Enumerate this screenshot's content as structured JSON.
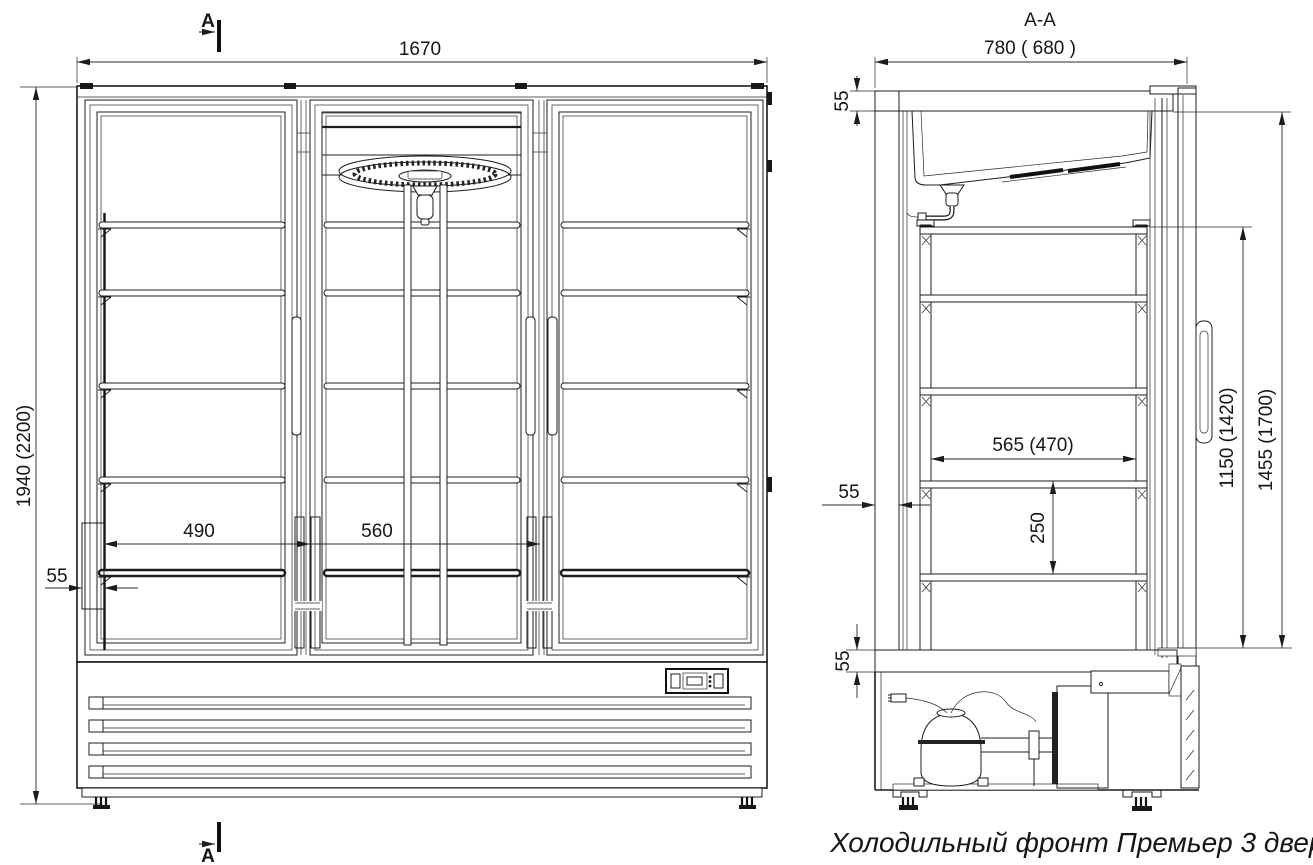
{
  "title": "Холодильный фронт Премьер 3 двери.",
  "section_cut": {
    "label": "A",
    "view_label": "A-A"
  },
  "front_view": {
    "dim_width": "1670",
    "dim_height": "1940 (2200)",
    "dim_wall": "55",
    "dim_door_left": "490",
    "dim_door_mid": "560"
  },
  "section_view": {
    "dim_depth": "780 ( 680 )",
    "dim_top_insulation": "55",
    "dim_back_wall": "55",
    "dim_bottom_insulation": "55",
    "dim_shelf_depth": "565 (470)",
    "dim_shelf_pitch": "250",
    "dim_rack_height": "1150 (1420)",
    "dim_interior_height": "1455 (1700)"
  },
  "colors": {
    "line": "#1c1c1c",
    "background": "#ffffff"
  }
}
